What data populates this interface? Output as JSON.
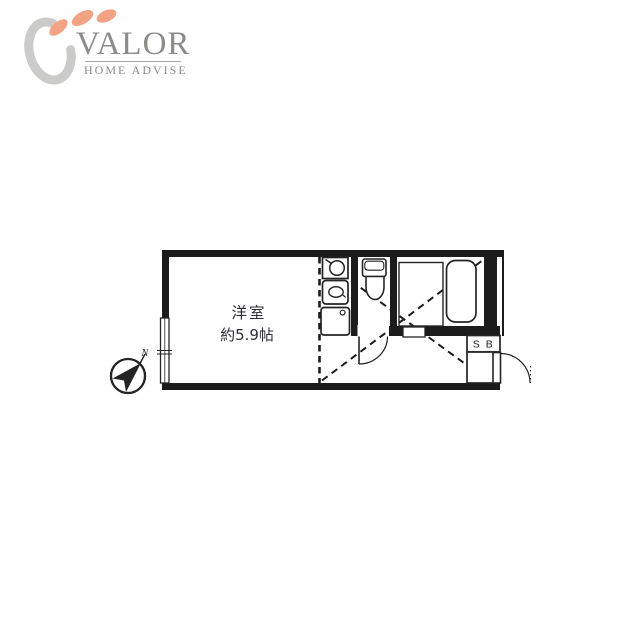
{
  "logo": {
    "brand": "VALOR",
    "tagline": "HOME ADVISE",
    "petal_color": "#f2a384",
    "swoosh_color": "#cbcbc9",
    "text_color": "#8b8b89"
  },
  "floorplan": {
    "room_label": "洋室",
    "room_size": "約5.9帖",
    "shoebox_label": "S B",
    "north_label": "N",
    "wall_color": "#1c1c1c"
  }
}
